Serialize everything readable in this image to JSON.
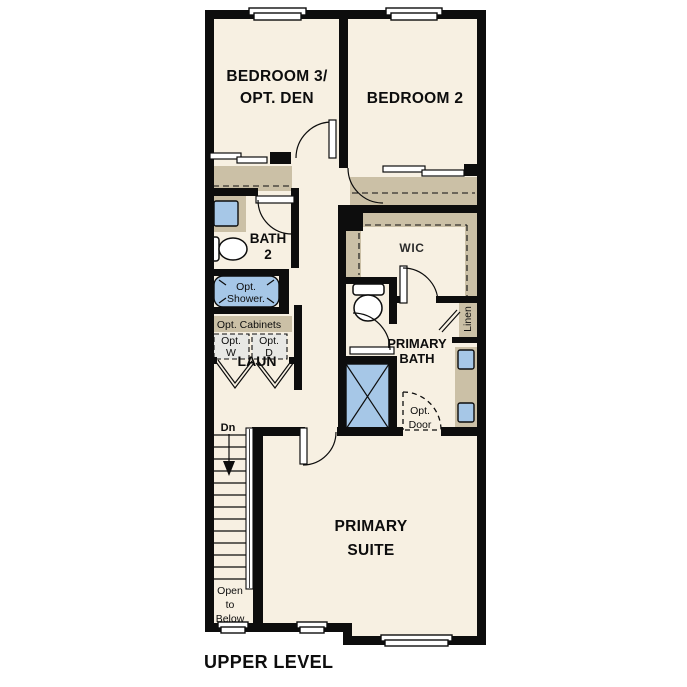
{
  "plan": {
    "title": "UPPER LEVEL",
    "rooms": {
      "bedroom3_line1": "BEDROOM 3/",
      "bedroom3_line2": "OPT. DEN",
      "bedroom2": "BEDROOM 2",
      "bath2_line1": "BATH",
      "bath2_line2": "2",
      "wic": "WIC",
      "primary_bath_line1": "PRIMARY",
      "primary_bath_line2": "BATH",
      "laundry": "LAUN",
      "primary_suite_line1": "PRIMARY",
      "primary_suite_line2": "SUITE"
    },
    "features": {
      "opt_shower_line1": "Opt.",
      "opt_shower_line2": "Shower.",
      "opt_cabinets": "Opt. Cabinets",
      "opt_washer_line1": "Opt.",
      "opt_washer_line2": "W",
      "opt_dryer_line1": "Opt.",
      "opt_dryer_line2": "D",
      "linen": "Linen",
      "opt_door_line1": "Opt.",
      "opt_door_line2": "Door",
      "stairs_down": "Dn",
      "open_below_line1": "Open",
      "open_below_line2": "to",
      "open_below_line3": "Below"
    },
    "colors": {
      "floor": "#f7f0e2",
      "wall": "#0d0d0d",
      "casework_tan": "#cbc0a6",
      "fixture_blue": "#a6c7e7",
      "appliance_gray": "#e8e8e5"
    }
  }
}
